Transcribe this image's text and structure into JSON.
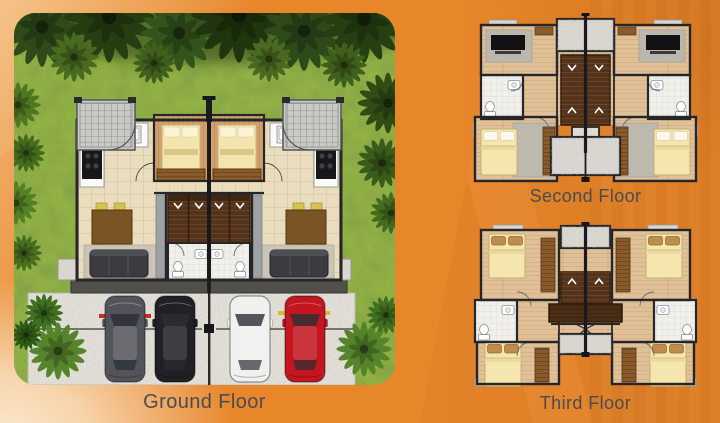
{
  "document": {
    "kind": "duplex floor-plan brochure page"
  },
  "floors": [
    {
      "id": "ground",
      "label": "Ground Floor"
    },
    {
      "id": "second",
      "label": "Second Floor"
    },
    {
      "id": "third",
      "label": "Third Floor"
    }
  ],
  "scene": {
    "ground_floor": {
      "landscape": [
        "palm-trees",
        "lawn",
        "driveway",
        "trellis-canopies"
      ],
      "units": 2,
      "rooms": [
        "entry-porch",
        "kitchen",
        "dining-area",
        "living-area",
        "staircase",
        "bathroom"
      ],
      "cars": [
        {
          "type": "suv",
          "color": "#53535A"
        },
        {
          "type": "suv",
          "color": "#202025"
        },
        {
          "type": "suv",
          "color": "#F0F0EE"
        },
        {
          "type": "sedan",
          "color": "#C3161F"
        }
      ]
    },
    "second_floor": {
      "units": 2,
      "rooms": [
        "family-area-tv",
        "bathroom",
        "bedroom",
        "staircase",
        "deck"
      ]
    },
    "third_floor": {
      "units": 2,
      "rooms": [
        "bedroom",
        "bedroom",
        "bathroom",
        "staircase",
        "deck"
      ]
    }
  },
  "colors": {
    "background": "#E8862A",
    "label_text": "#4B4C52",
    "grass": "#8FAF3E",
    "canopy": "#24400F",
    "tile_floor": "#E9DDBD",
    "wood_floor": "#DFC097",
    "porch_wood": "#D2A06C",
    "stairs": "#53331C",
    "bathroom": "#F1F0EB",
    "bed": "#F4E6AE",
    "driveway": "#E9E7E0",
    "walls": "#26262A"
  }
}
